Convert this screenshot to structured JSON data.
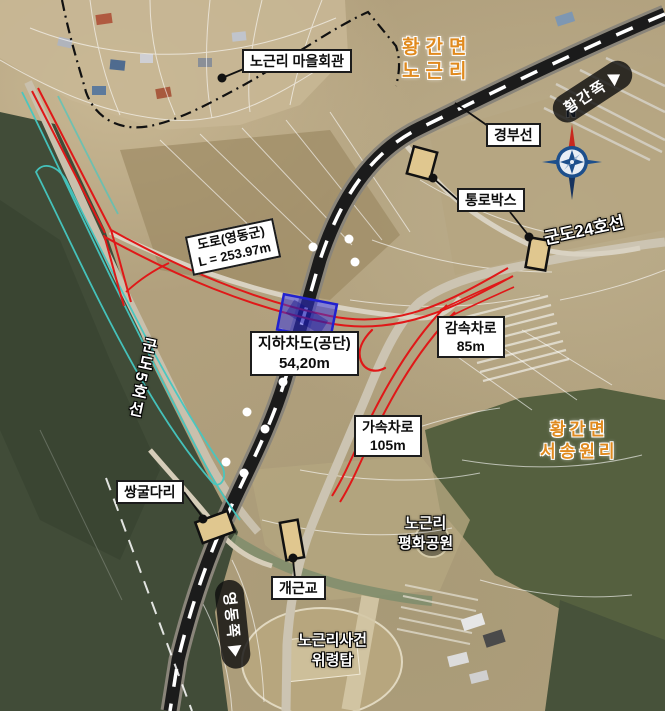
{
  "colors": {
    "new_road_red": "#e01818",
    "underpass_blue": "#2a2ad0",
    "structure_tan": "#e0c78f",
    "stream_teal": "#45c8c2",
    "region_orange": "#e08a1e",
    "railway_black": "#1a1a1a",
    "sign_capsule_bg": "#141414"
  },
  "compass": {
    "north_label": "N"
  },
  "direction_signs": {
    "northeast": "황간쪽",
    "southwest": "영동쪽"
  },
  "region_labels": {
    "northeast": {
      "line1": "황간면",
      "line2": "노근리"
    },
    "southeast": {
      "line1": "황간면",
      "line2": "서송원리"
    }
  },
  "place_labels": {
    "village_hall": "노근리 마을회관",
    "railway": "경부선",
    "passage_box": "통로박스",
    "county_road_24": "군도24호선",
    "county_road_5": "군도5호선",
    "twin_tunnel": "쌍굴다리",
    "gaegeun_bridge": "개근교",
    "peace_park": {
      "line1": "노근리",
      "line2": "평화공원"
    },
    "memorial": {
      "line1": "노근리사건",
      "line2": "위령탑"
    }
  },
  "measurements": {
    "road": {
      "line1": "도로(영동군)",
      "line2": "L = 253.97m"
    },
    "underpass": {
      "line1": "지하차도(공단)",
      "line2": "54,20m"
    },
    "decel_lane": {
      "line1": "감속차로",
      "line2": "85m"
    },
    "accel_lane": {
      "line1": "가속차로",
      "line2": "105m"
    }
  }
}
